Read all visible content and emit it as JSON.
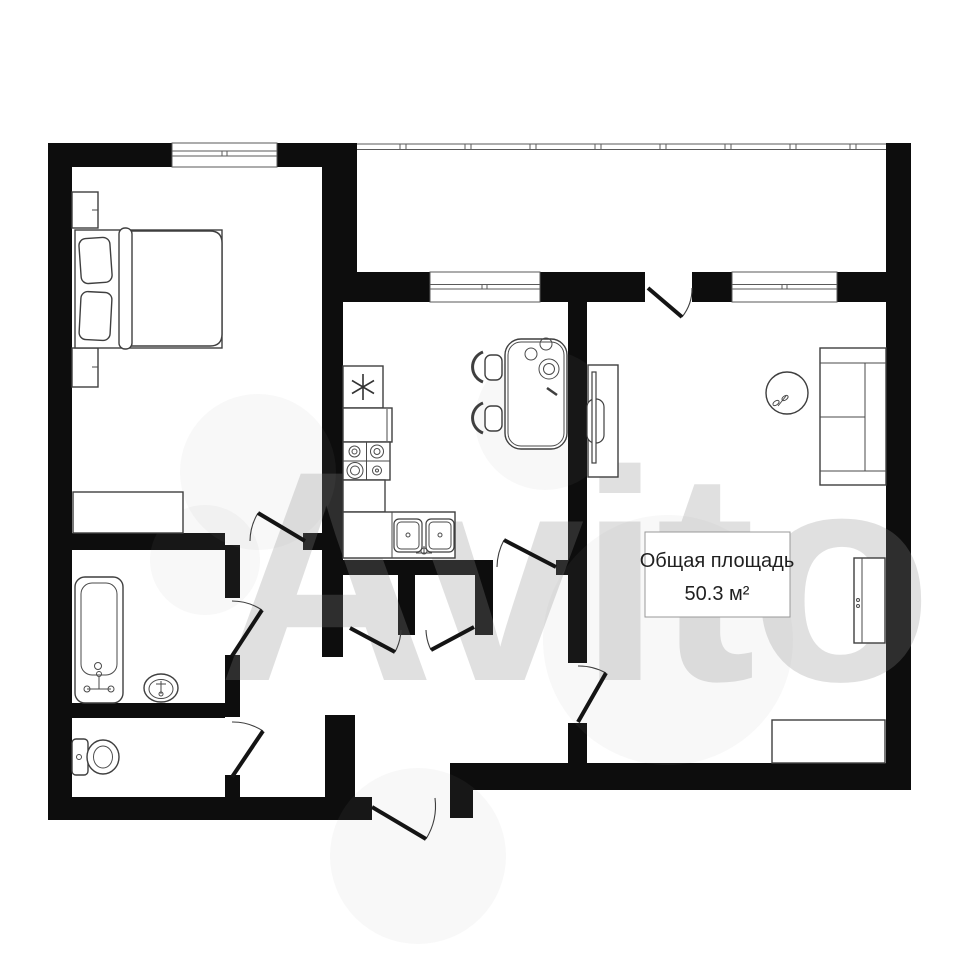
{
  "floorplan": {
    "watermark": "Avito",
    "area_label": {
      "title": "Общая площадь",
      "value": "50.3 м²"
    },
    "icons": {
      "fridge": "snowflake-icon",
      "plant": "plant-icon"
    },
    "colors": {
      "background": "#ffffff",
      "walls": "#0d0d0d",
      "furniture_stroke": "#3f3f3f",
      "door_leaf": "#141414",
      "label_border": "#999999",
      "label_text": "#1f1f1f",
      "watermark_gray": "#8c8c8c"
    }
  }
}
